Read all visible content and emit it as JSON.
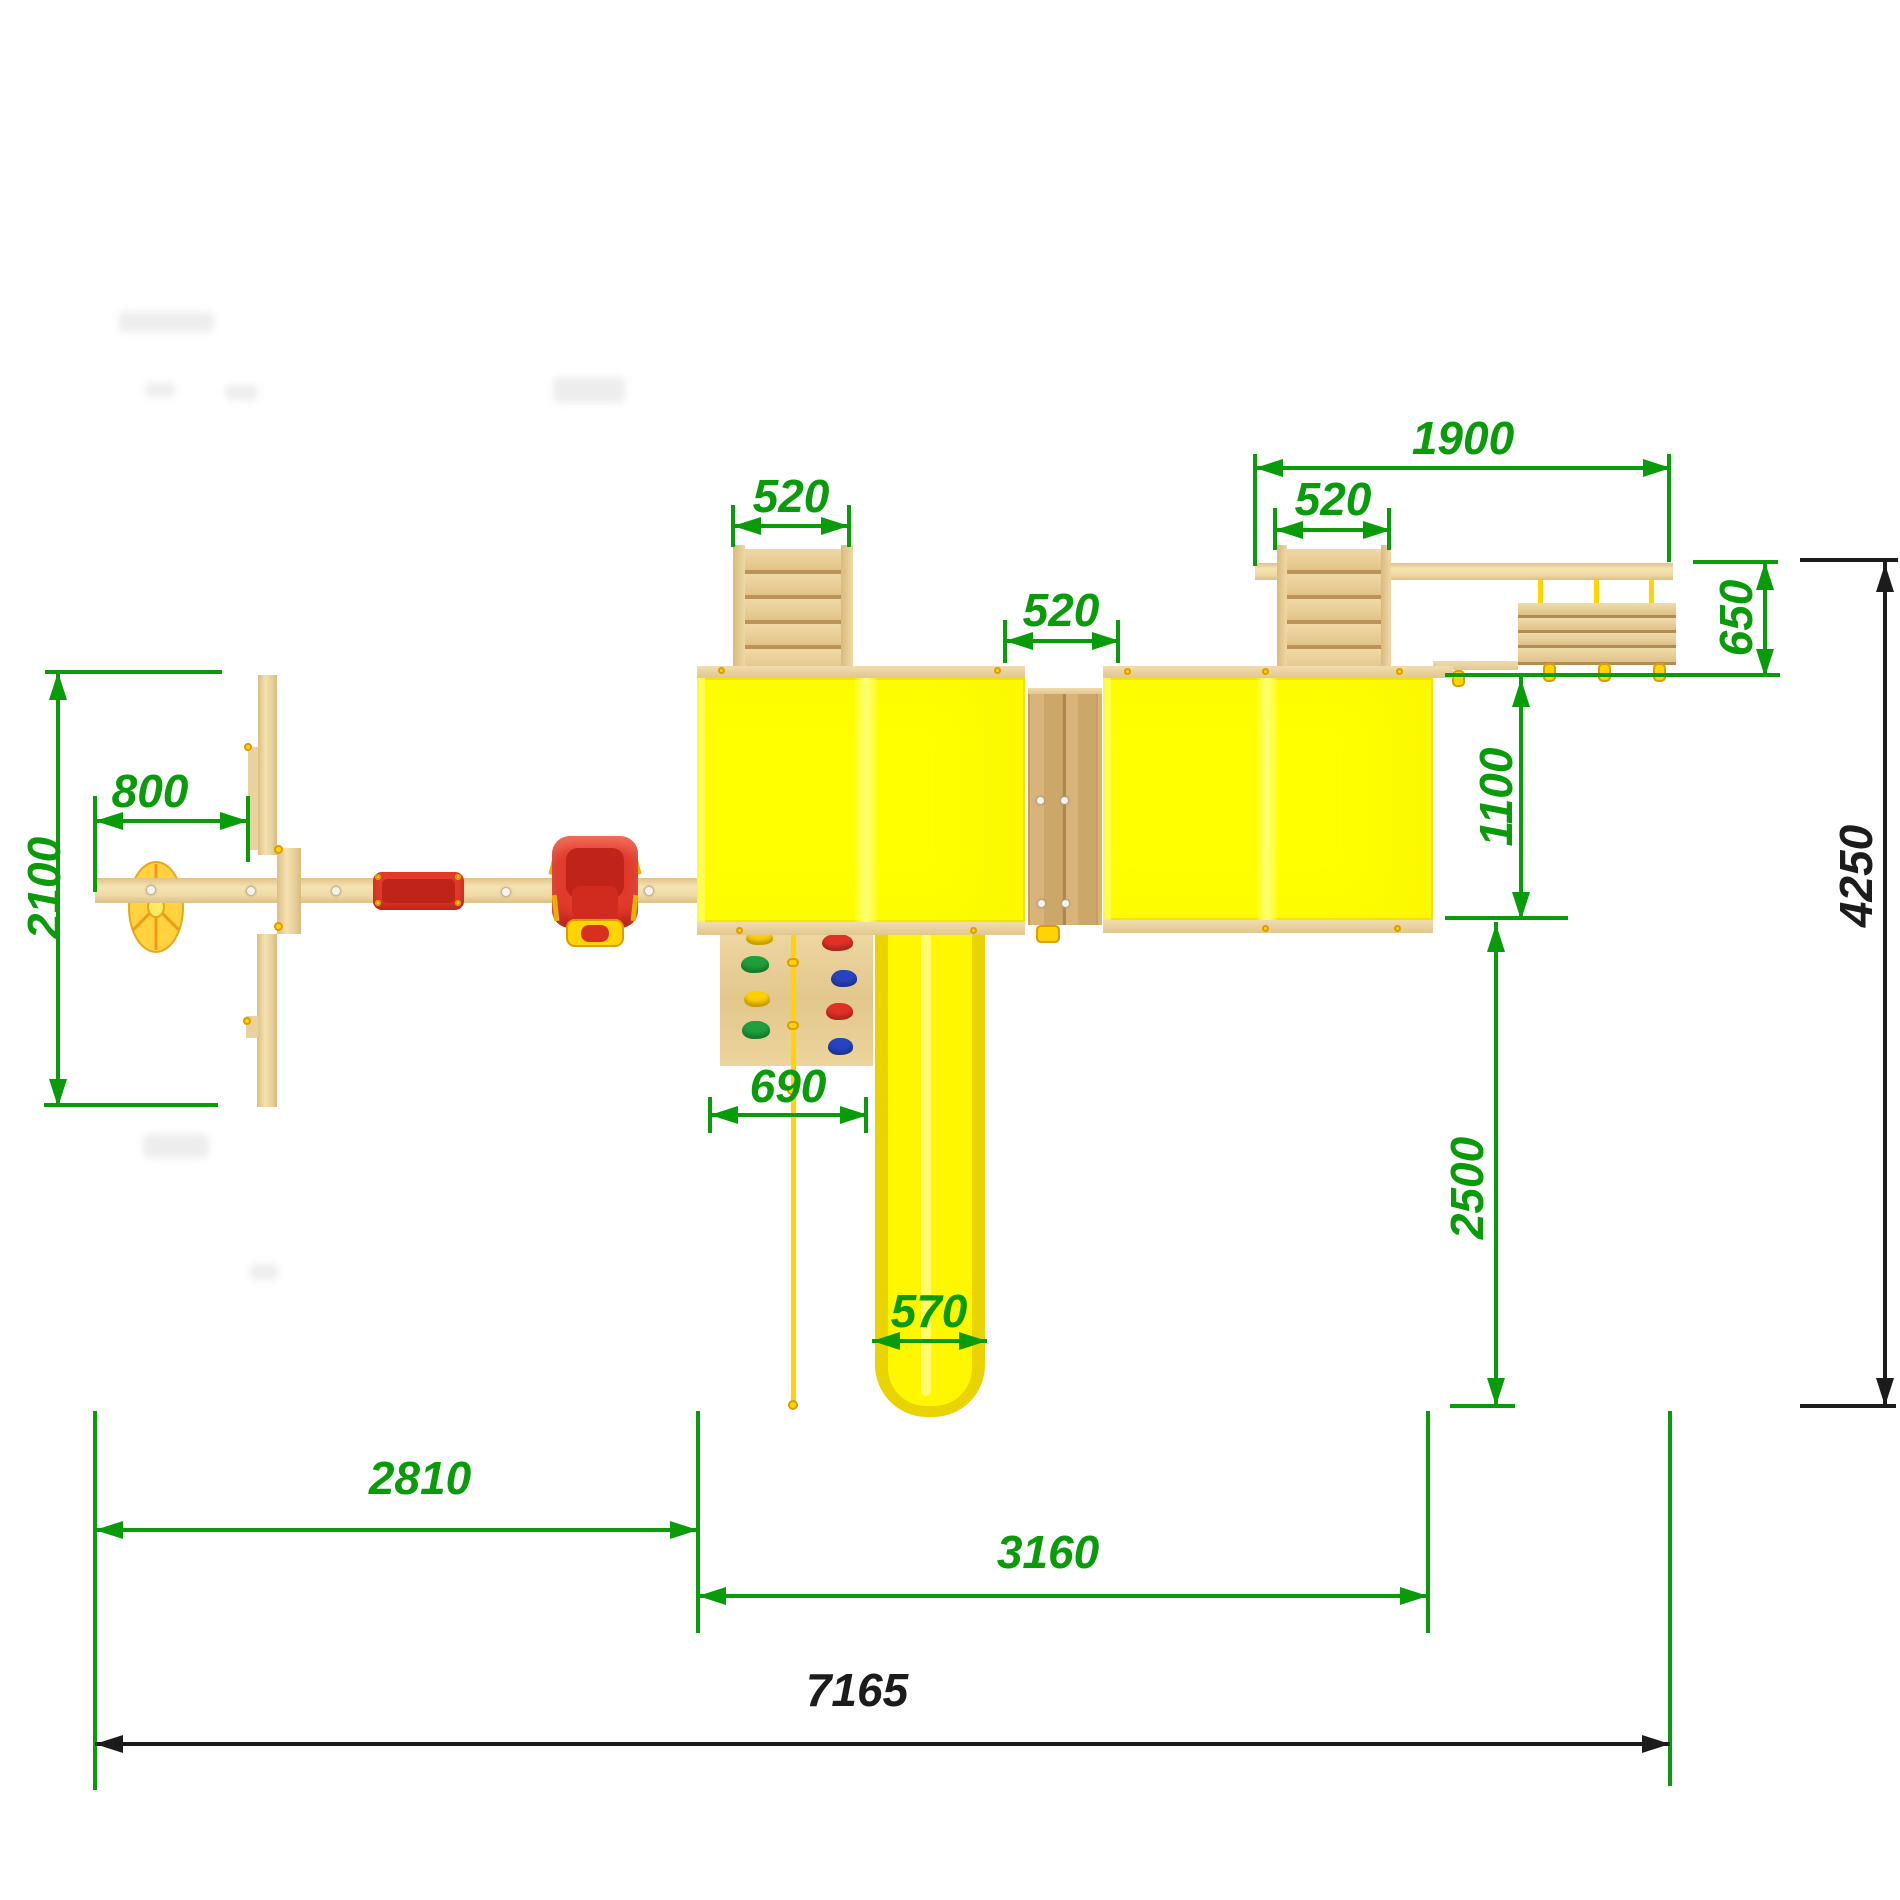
{
  "drawing": {
    "kind": "playground-set top view installation plan",
    "units": "mm"
  },
  "dims": {
    "d800": "800",
    "d2100": "2100",
    "d520_ladder1": "520",
    "d520_bridge": "520",
    "d520_ladder2": "520",
    "d1900": "1900",
    "d650": "650",
    "d1100": "1100",
    "d2500": "2500",
    "d4250": "4250",
    "d690": "690",
    "d570": "570",
    "d2810": "2810",
    "d3160": "3160",
    "d7165": "7165"
  },
  "colors": {
    "dim_green": "#0a9b0a",
    "dim_black": "#1c1c1c",
    "roof_yellow": "#ffff00",
    "roof_stripe": "#ffff78",
    "slide_rail": "#e9d400",
    "slide_surface": "#fff700",
    "slide_highlight": "#fffd8a",
    "rope_yellow": "#ffd400",
    "carousel_gold": "#ffd23e",
    "carousel_spoke": "#ef9b18",
    "seat_red": "#e23a2b",
    "seat_red_dark": "#c02418",
    "hold_yellow": "#ffcf00",
    "hold_red": "#e03127",
    "hold_green": "#1f9e3c",
    "hold_blue": "#2743c0",
    "wood_light": "#f2dca6",
    "wood_plank": "#cfae74"
  },
  "components": {
    "carousel": "carousel-disc",
    "seesaw": "seesaw-post-unit",
    "swing_beam": "swing-beam",
    "flat_swing": "flat-swing-seat",
    "baby_swing": "baby-swing-seat",
    "tower_left": "tower-roof-left",
    "tower_right": "tower-roof-right",
    "ladder_left": "ladder-left",
    "ladder_right": "ladder-right",
    "bridge": "plank-bridge",
    "monkey_beam": "monkey-bar-beam",
    "rope_bridge": "rope-net-bridge",
    "slide": "slide",
    "climb_wall": "climbing-wall",
    "climb_rope": "climbing-rope"
  }
}
